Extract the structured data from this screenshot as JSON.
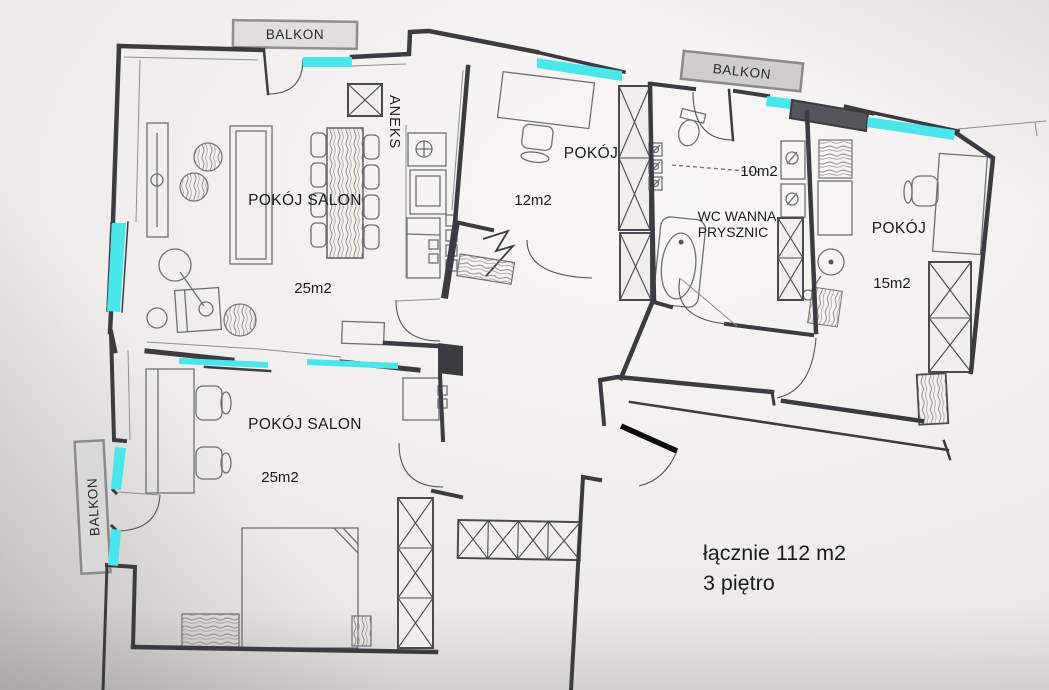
{
  "balconies": {
    "top_left": "BALKON",
    "top_right": "BALKON",
    "left": "BALKON"
  },
  "rooms": {
    "salon_top": {
      "name": "POKÓJ SALON",
      "area": "25m2"
    },
    "aneks": {
      "name": "ANEKS"
    },
    "room12": {
      "name": "POKÓJ",
      "area": "12m2"
    },
    "bathroom": {
      "line1": "WC WANNA",
      "line2": "PRYSZNIC",
      "area": "10m2"
    },
    "room15": {
      "name": "POKÓJ",
      "area": "15m2"
    },
    "salon_bottom": {
      "name": "POKÓJ SALON",
      "area": "25m2"
    }
  },
  "summary": {
    "total": "łącznie 112 m2",
    "floor": "3 piętro"
  },
  "colors": {
    "window_glass": "#49e6ec",
    "wall": "#3b3b41",
    "balcony_fill": "#d9d9d8",
    "balcony_border": "#8f8f8f",
    "paper": "#f0eeec",
    "text": "#1b1b1e"
  }
}
